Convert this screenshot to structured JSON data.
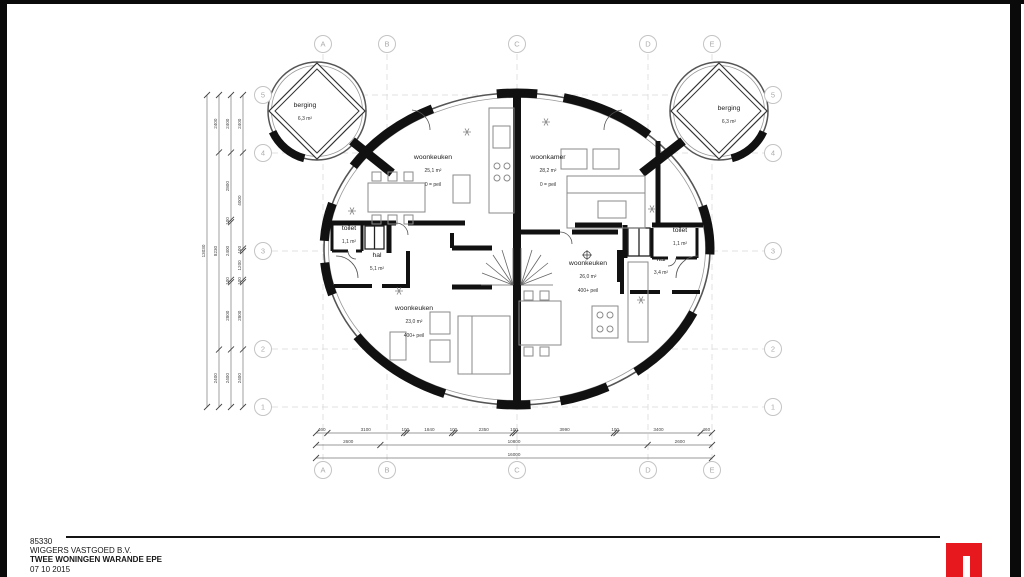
{
  "title_block": {
    "project_number": "85330",
    "client": "WIGGERS VASTGOED B.V.",
    "project_name": "TWEE WONINGEN WARANDE EPE",
    "date": "07 10 2015"
  },
  "logo": {
    "color": "#e8191e"
  },
  "grid": {
    "columns": [
      "A",
      "B",
      "C",
      "D",
      "E"
    ],
    "rows": [
      "5",
      "4",
      "3",
      "2",
      "1"
    ]
  },
  "dimensions": {
    "left_columns": [
      [
        "13030"
      ],
      [
        "2400",
        "8230",
        "2400"
      ],
      [
        "2400",
        "2800",
        "100",
        "2400",
        "100",
        "2800",
        "2400"
      ],
      [
        "2400",
        "4000",
        "100",
        "1200",
        "100",
        "2800",
        "2400"
      ]
    ],
    "bottom_rows": [
      [
        "460",
        "3100",
        "100",
        "1840",
        "100",
        "2350",
        "100",
        "3990",
        "100",
        "3400",
        "460"
      ],
      [
        "2600",
        "10800",
        "2600"
      ],
      [
        "16000"
      ]
    ]
  },
  "rooms": [
    {
      "id": "berging-left",
      "name": "berging",
      "area": "6,3 m²",
      "peil": ""
    },
    {
      "id": "berging-right",
      "name": "berging",
      "area": "6,3 m²",
      "peil": ""
    },
    {
      "id": "woonkeuken-tl",
      "name": "woonkeuken",
      "area": "25,1 m²",
      "peil": "0 = peil"
    },
    {
      "id": "woonkamer-tr",
      "name": "woonkamer",
      "area": "28,2 m²",
      "peil": "0 = peil"
    },
    {
      "id": "toilet-left",
      "name": "toilet",
      "area": "1,1 m²",
      "peil": ""
    },
    {
      "id": "hal-left",
      "name": "hal",
      "area": "5,1 m²",
      "peil": ""
    },
    {
      "id": "toilet-right",
      "name": "toilet",
      "area": "1,1 m²",
      "peil": ""
    },
    {
      "id": "hal-right",
      "name": "hal",
      "area": "3,4 m²",
      "peil": ""
    },
    {
      "id": "woonkeuken-cr",
      "name": "woonkeuken",
      "area": "26,0 m²",
      "peil": "400+ peil"
    },
    {
      "id": "woonkeuken-bl",
      "name": "woonkeuken",
      "area": "23,0 m²",
      "peil": "400+ peil"
    }
  ]
}
